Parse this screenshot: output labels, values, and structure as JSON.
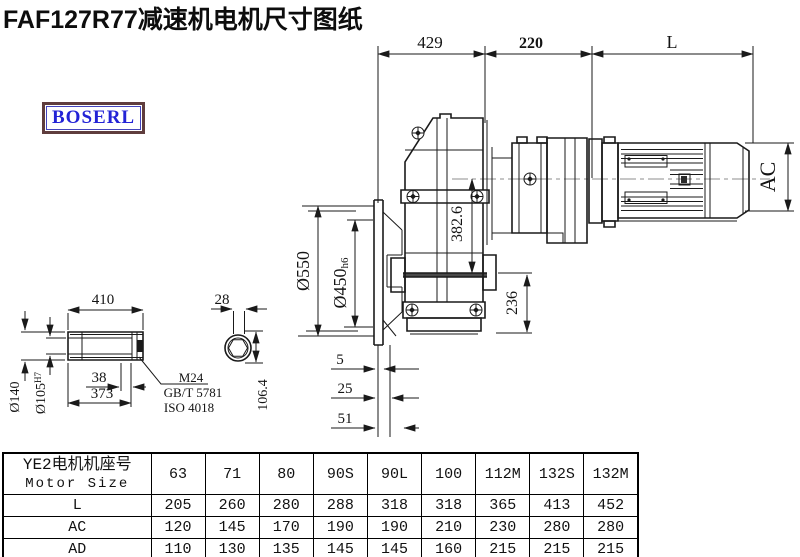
{
  "title": "FAF127R77减速机电机尺寸图纸",
  "logo": "BOSERL",
  "dimensions": {
    "top_429": "429",
    "top_220": "220",
    "motor_length": "L",
    "motor_ac": "AC",
    "flange_od": "Ø550",
    "spigot": "Ø450",
    "spigot_tol": "h6",
    "height_382": "382.6",
    "height_236": "236",
    "shaft_len": "410",
    "shaft_38": "38",
    "shaft_373": "373",
    "hub_od": "Ø140",
    "bore": "Ø105",
    "bore_tol": "H7",
    "bolt": "M24",
    "bolt_std_gb": "GB/T 5781",
    "bolt_std_iso": "ISO 4018",
    "key_28": "28",
    "across_106": "106.4",
    "off_5": "5",
    "off_25": "25",
    "off_51": "51"
  },
  "table": {
    "header_cn": "YE2电机机座号",
    "header_en": "Motor Size",
    "sizes": [
      "63",
      "71",
      "80",
      "90S",
      "90L",
      "100",
      "112M",
      "132S",
      "132M"
    ],
    "rows": [
      {
        "label": "L",
        "values": [
          "205",
          "260",
          "280",
          "288",
          "318",
          "318",
          "365",
          "413",
          "452"
        ]
      },
      {
        "label": "AC",
        "values": [
          "120",
          "145",
          "170",
          "190",
          "190",
          "210",
          "230",
          "280",
          "280"
        ]
      },
      {
        "label": "AD",
        "values": [
          "110",
          "130",
          "135",
          "145",
          "145",
          "160",
          "215",
          "215",
          "215"
        ]
      }
    ]
  }
}
